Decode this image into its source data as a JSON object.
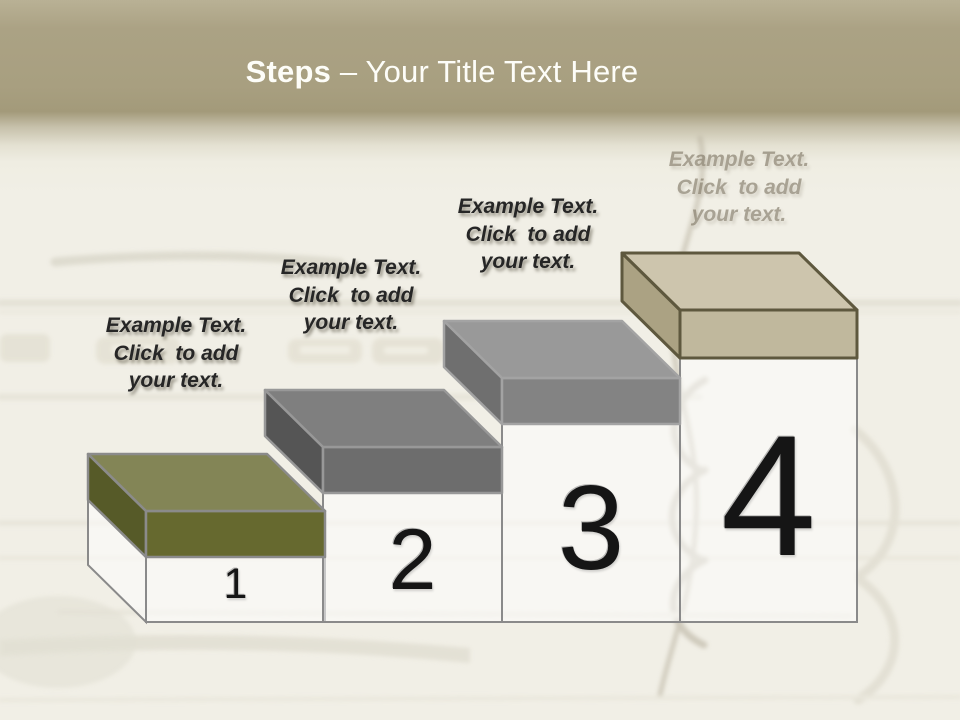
{
  "title": {
    "bold": "Steps",
    "rest": "– Your Title Text Here"
  },
  "steps": [
    {
      "number": "1",
      "label": [
        "Example Text.",
        "Click  to add",
        "your text."
      ],
      "colors": {
        "top": "#838556",
        "left": "#565a28",
        "front": "#66692f",
        "outline": "#8b8b8b"
      }
    },
    {
      "number": "2",
      "label": [
        "Example Text.",
        "Click  to add",
        "your text."
      ],
      "colors": {
        "top": "#7f7f7f",
        "left": "#555555",
        "front": "#6d6d6d",
        "outline": "#989898"
      }
    },
    {
      "number": "3",
      "label": [
        "Example Text.",
        "Click  to add",
        "your text."
      ],
      "colors": {
        "top": "#999999",
        "left": "#6f6f6f",
        "front": "#838383",
        "outline": "#a3a3a3"
      }
    },
    {
      "number": "4",
      "label": [
        "Example Text.",
        "Click  to add",
        "your text."
      ],
      "colors": {
        "top": "#cdc5ad",
        "left": "#aba283",
        "front": "#c0b89d",
        "outline": "#5e583e"
      }
    }
  ],
  "colors": {
    "header_band": "#a89f80",
    "page_bg": "#f1efe6",
    "column_outline": "#8a8a8a",
    "title_text": "#fdfdf8",
    "number_text": "#151515",
    "label_text": "#262626",
    "faded_label_text": "#7d7462"
  }
}
